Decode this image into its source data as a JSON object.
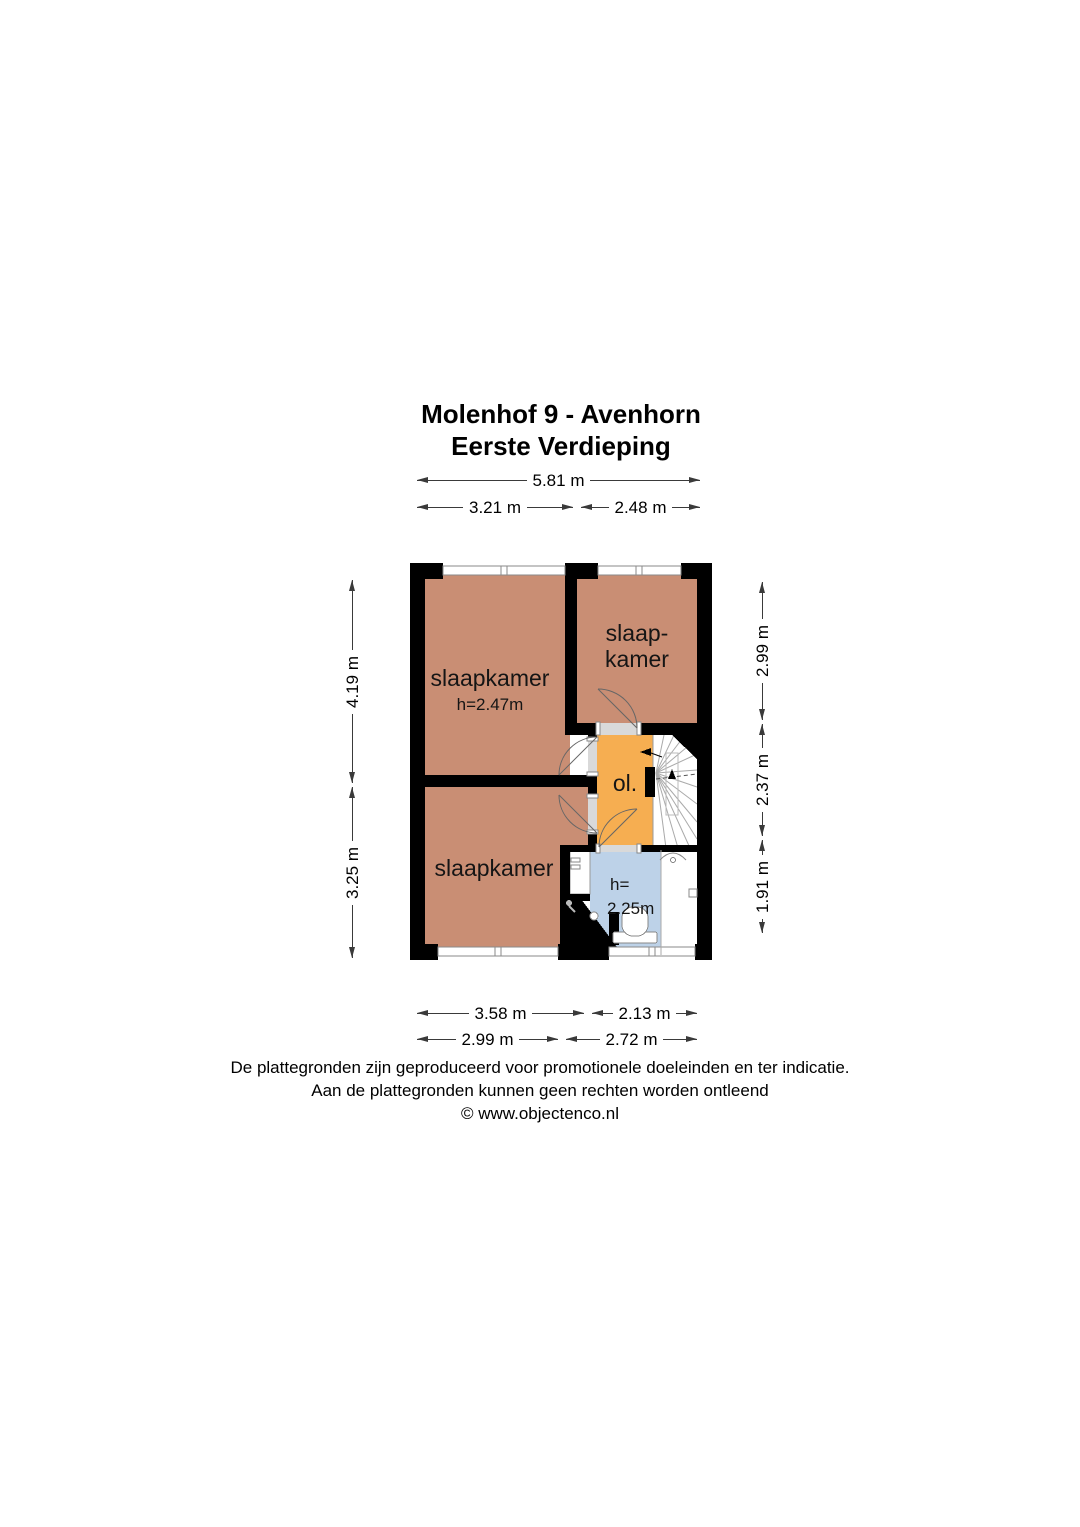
{
  "title": {
    "line1": "Molenhof 9 - Avenhorn",
    "line2": "Eerste Verdieping"
  },
  "dimensions": {
    "top_total": "5.81 m",
    "top_left": "3.21 m",
    "top_right": "2.48 m",
    "left_upper": "4.19 m",
    "left_lower": "3.25 m",
    "right_upper": "2.99 m",
    "right_middle": "2.37 m",
    "right_lower": "1.91 m",
    "bottom_row1_left": "3.58 m",
    "bottom_row1_right": "2.13 m",
    "bottom_row2_left": "2.99 m",
    "bottom_row2_right": "2.72 m"
  },
  "rooms": {
    "bedroom_top_left": {
      "name": "slaapkamer",
      "ceiling_height": "h=2.47m"
    },
    "bedroom_top_right": {
      "name_line1": "slaap-",
      "name_line2": "kamer"
    },
    "bedroom_bottom": {
      "name": "slaapkamer"
    },
    "landing": {
      "name": "ol."
    },
    "bathroom": {
      "height_label": "h=",
      "height_value": "2.25m"
    }
  },
  "footer": {
    "line1": "De plattegronden zijn geproduceerd voor promotionele doeleinden en ter indicatie.",
    "line2": "Aan de plattegronden kunnen geen rechten worden ontleend",
    "line3": "© www.objectenco.nl"
  },
  "colors": {
    "bedroom_fill": "#c98e74",
    "landing_fill": "#f6ae51",
    "bathroom_fill": "#bdd2e8",
    "wall": "#000000",
    "page_background": "#ffffff"
  }
}
